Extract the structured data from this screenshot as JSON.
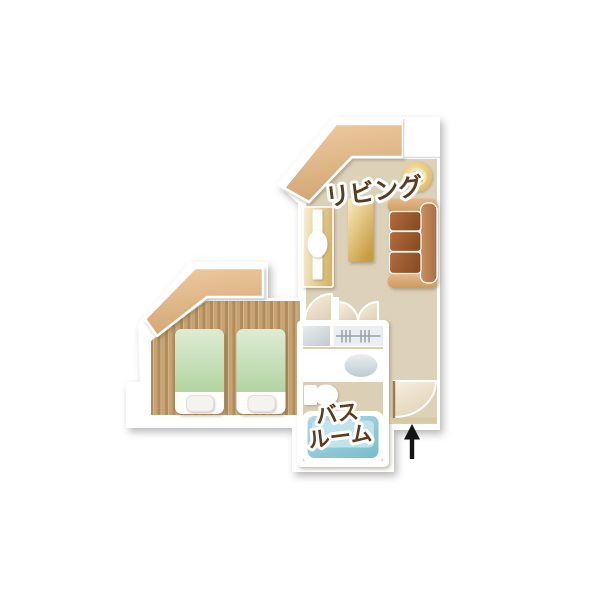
{
  "page": {
    "background": "#ffffff"
  },
  "floorplan": {
    "labels": {
      "living": "リビング",
      "bath_line1": "バス",
      "bath_line2": "ルーム"
    },
    "entrance_arrow_direction": "up",
    "colors": {
      "wall_band": "#ddb184",
      "floor_beige": "#ddd1ba",
      "wood_floor": "#c6a375",
      "wood_stripe": "#b18c5c",
      "bed_green": "#c6dfb7",
      "sofa_dark": "#9a5c31",
      "sofa_mid": "#bc8258",
      "sofa_light": "#d9aa78",
      "table_gold": "#e3bd6d",
      "lamp_gold": "#e8cf8d",
      "bathtub_blue": "#96ced9",
      "fixture_gray": "#dfe4e8",
      "door_cream": "#eee4d1",
      "label_brown": "#5d3d1d",
      "arrow_black": "#141414"
    },
    "furniture_icons": [
      "floor-lamp-icon",
      "sofa-icon",
      "coffee-table-icon",
      "tv-counter-icon",
      "bed-icon",
      "bed-icon",
      "luggage-shelf-icon",
      "hanger-closet-icon",
      "washbasin-icon",
      "toilet-icon",
      "bathtub-icon",
      "door-swing-icon",
      "entrance-arrow-icon"
    ]
  }
}
